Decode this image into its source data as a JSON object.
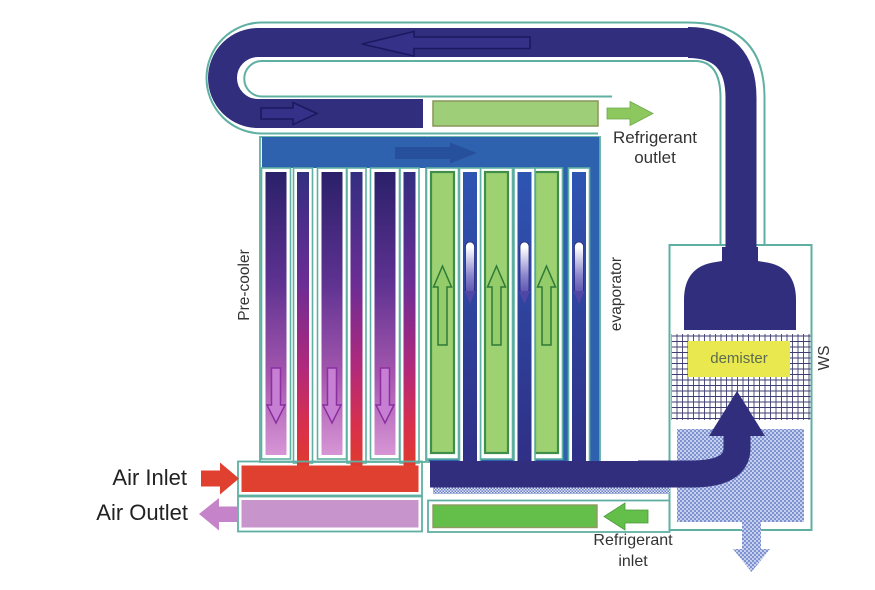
{
  "labels": {
    "refrigerant_outlet": {
      "line1": "Refrigerant",
      "line2": "outlet"
    },
    "refrigerant_inlet": {
      "line1": "Refrigerant",
      "line2": "inlet"
    },
    "air_inlet": "Air Inlet",
    "air_outlet": "Air Outlet",
    "pre_cooler": "Pre-cooler",
    "evaporator": "evaporator",
    "ws": "WS",
    "demister": "demister"
  },
  "colors": {
    "duct_navy": "#312e7d",
    "duct_outline": "#1c1960",
    "casing_teal": "#5fb0a2",
    "header_blue": "#2f62ae",
    "header_arrow_blue": "#27509c",
    "green_bar_top": "#9ecf78",
    "green_arrow_top": "#8cc85e",
    "green_bar_bottom": "#63bf4a",
    "green_tube": "#9ed172",
    "air_inlet_red": "#e04030",
    "air_outlet_pink": "#c583c9",
    "precooler_tube_top": "#2a2069",
    "precooler_tube_bottom": "#d795d5",
    "precooler_narrow_bottom": "#e03a2e",
    "demister_yellow": "#e9e94f",
    "water_blue": "#7e92d0",
    "mesh_line": "#3e3e72"
  }
}
